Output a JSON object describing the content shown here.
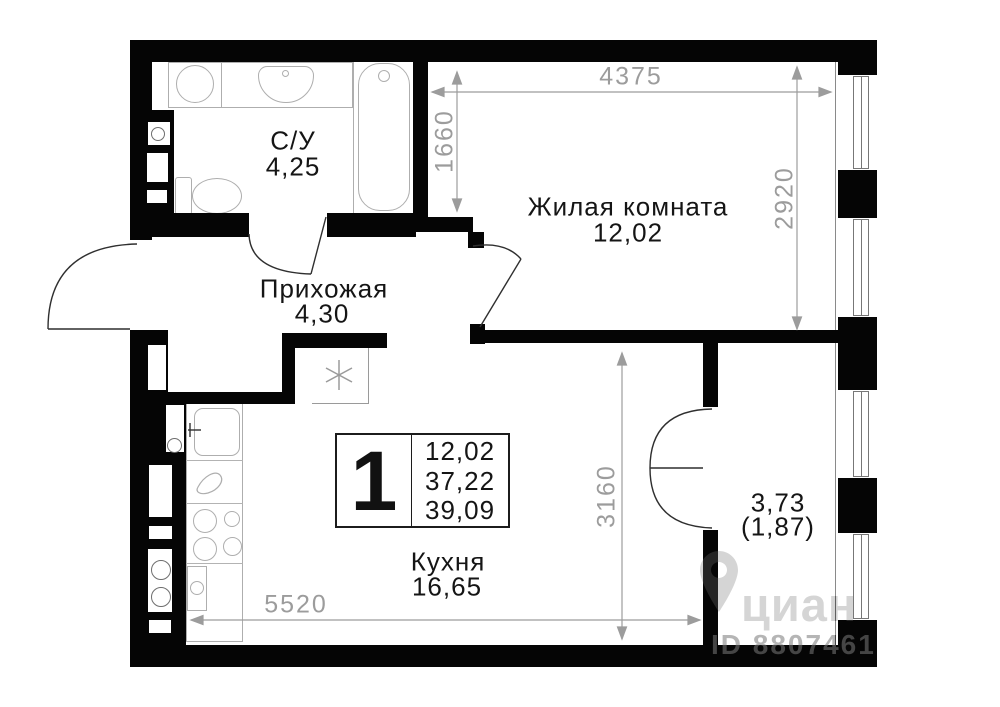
{
  "plan": {
    "rooms": [
      {
        "key": "bathroom",
        "name": "С/У",
        "area": "4,25"
      },
      {
        "key": "living-room",
        "name": "Жилая комната",
        "area": "12,02"
      },
      {
        "key": "hallway",
        "name": "Прихожая",
        "area": "4,30"
      },
      {
        "key": "kitchen",
        "name": "Кухня",
        "area": "16,65"
      },
      {
        "key": "balcony",
        "name": "3,73",
        "area": "(1,87)"
      }
    ],
    "legend": {
      "rooms_count": "1",
      "living_area": "12,02",
      "area_without_balcony": "37,22",
      "total_area": "39,09"
    },
    "dimensions": {
      "top": "4375",
      "living_left": "1660",
      "living_right": "2920",
      "kitchen_right": "3160",
      "bottom": "5520"
    },
    "watermark": {
      "brand": "циан",
      "id_text": "ID 8807461"
    },
    "colors": {
      "wall": "#050505",
      "dimension": "#9c9c9c",
      "fixture": "#aeaeae",
      "text": "#151515"
    }
  }
}
